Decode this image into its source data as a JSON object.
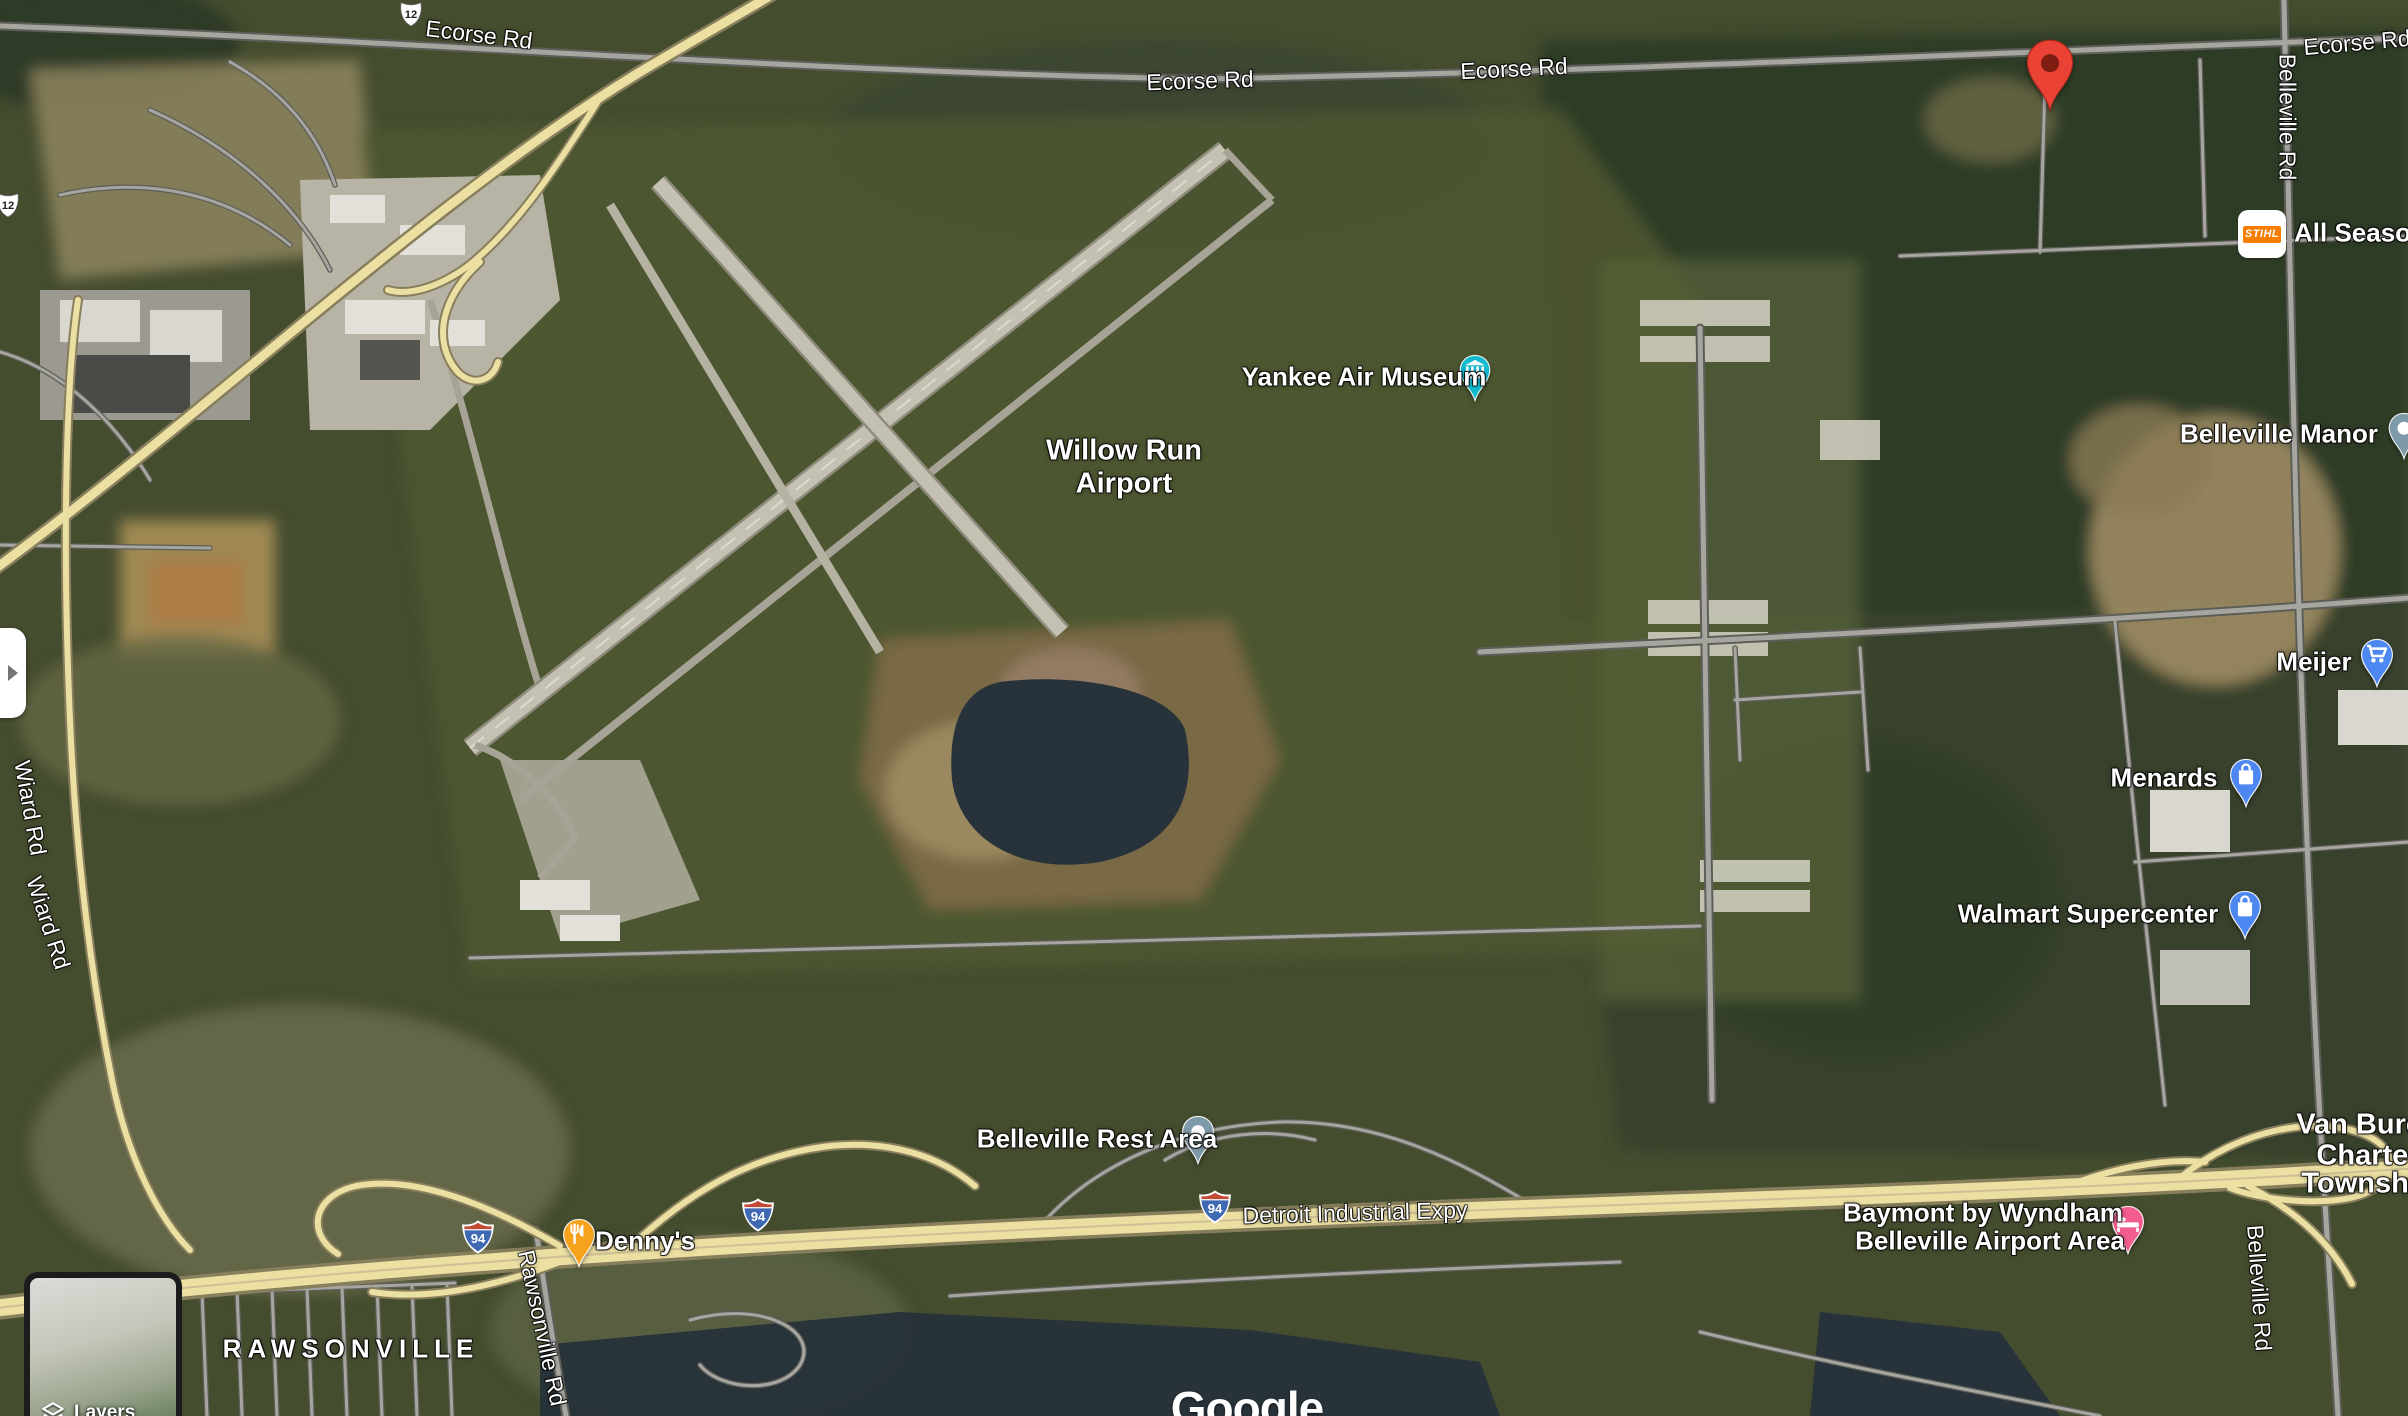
{
  "map_ui": {
    "layers_button": "Layers",
    "attribution": "Google"
  },
  "shields": {
    "us_12": "12",
    "i94": "94"
  },
  "road_labels": {
    "ecorse": "Ecorse Rd",
    "belleville": "Belleville Rd",
    "wiard": "Wiard Rd",
    "rawsonville": "Rawsonville Rd",
    "detroit_industrial": "Detroit Industrial Expy"
  },
  "place_labels": {
    "willow_run_line1": "Willow Run",
    "willow_run_line2": "Airport",
    "rawsonville_town": "RAWSONVILLE",
    "van_buren_line1": "Van Buren",
    "van_buren_line2": "Charter",
    "van_buren_line3": "Township"
  },
  "pois": {
    "yankee_air_museum": "Yankee Air Museum",
    "belleville_manor": "Belleville Manor",
    "meijer": "Meijer",
    "menards": "Menards",
    "walmart_supercenter": "Walmart Supercenter",
    "belleville_rest_area": "Belleville Rest Area",
    "dennys": "Denny's",
    "baymont_line1": "Baymont by Wyndham",
    "baymont_line2": "Belleville Airport Area",
    "all_seasons": "All Seasons",
    "stihl_brand": "STIHL"
  },
  "colors": {
    "pin-red": "#EA4335",
    "pin-red-inner": "#7F1D12",
    "pin-blue": "#4D88F2",
    "pin-teal": "#14B9CE",
    "pin-slate": "#7E99A8",
    "pin-orange": "#F6A21D",
    "pin-pink": "#F25C8E",
    "stihl-orange": "#F97E00",
    "road-yellow": "#EBDFA2",
    "road-yellow-edge": "#877E5C",
    "road-gray": "#A6A5A0",
    "road-gray-edge": "#5E5E58",
    "hwy-median": "#CDC096",
    "shield-blue": "#3F69B3",
    "shield-red": "#C14B36",
    "water": "#27323A"
  }
}
